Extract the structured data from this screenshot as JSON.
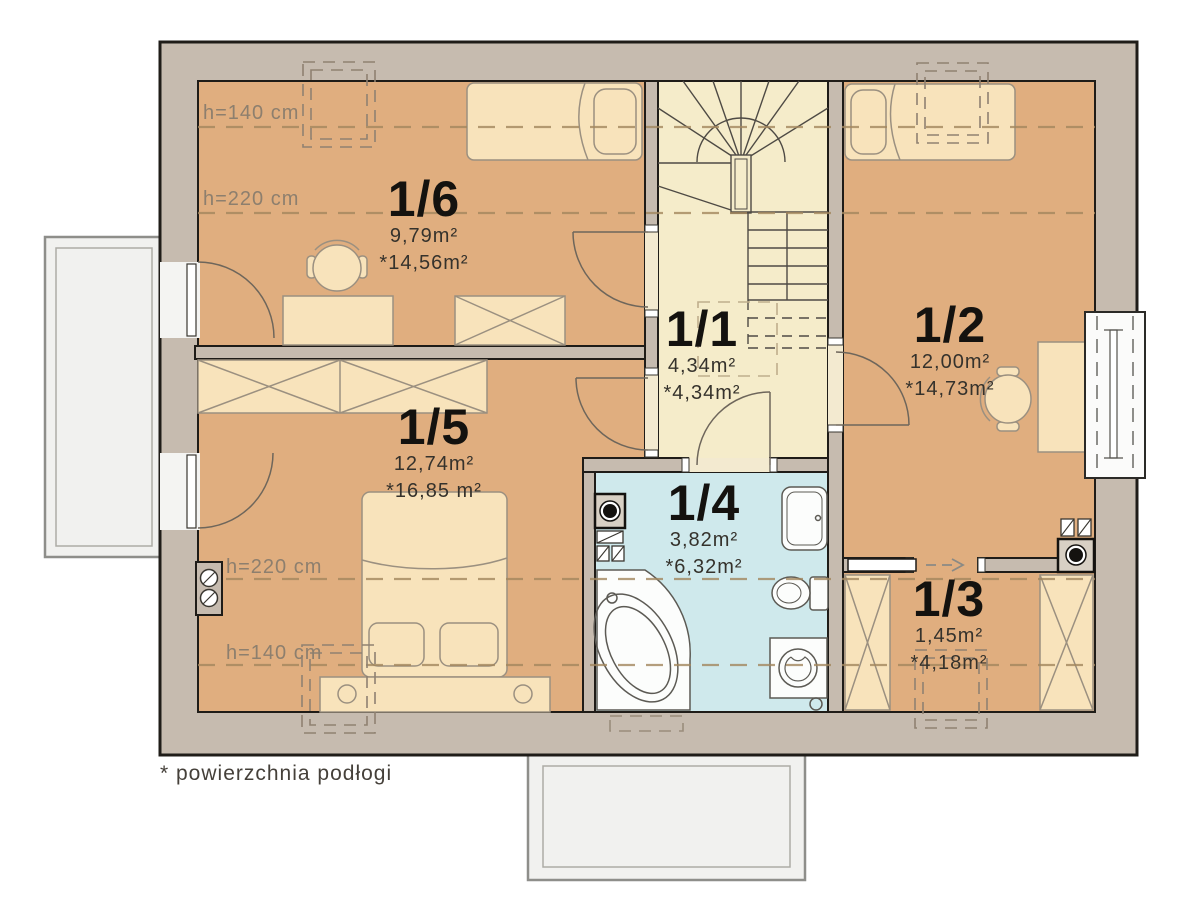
{
  "rooms": [
    {
      "id": "1/1",
      "area": "4,34m²",
      "floor_area": "*4,34m²"
    },
    {
      "id": "1/2",
      "area": "12,00m²",
      "floor_area": "*14,73m²"
    },
    {
      "id": "1/3",
      "area": "1,45m²",
      "floor_area": "*4,18m²"
    },
    {
      "id": "1/4",
      "area": "3,82m²",
      "floor_area": "*6,32m²"
    },
    {
      "id": "1/5",
      "area": "12,74m²",
      "floor_area": "*16,85 m²"
    },
    {
      "id": "1/6",
      "area": "9,79m²",
      "floor_area": "*14,56m²"
    }
  ],
  "height_labels": [
    {
      "text": "h=140 cm"
    },
    {
      "text": "h=220 cm"
    },
    {
      "text": "h=220 cm"
    },
    {
      "text": "h=140 cm"
    }
  ],
  "footnote": "* powierzchnia podłogi",
  "colors": {
    "wall": "#c6bbaf",
    "room_floor": "#e0ae7f",
    "hall_floor": "#f5ecca",
    "bath_floor": "#cfe9ec",
    "furniture": "#f8e3bb",
    "balcony": "#f1f1ef",
    "dash_line": "#a3875e",
    "outline": "#1f1c18"
  },
  "symbols": {
    "stairs": "winder-staircase",
    "bathtub": "corner-bathtub",
    "toilet": "toilet",
    "sink": "washbasin",
    "washer": "washing-machine",
    "chimney": "chimney-flue",
    "roof_window": "dashed-roof-window",
    "sliding_door": "sliding-door-arrow"
  }
}
